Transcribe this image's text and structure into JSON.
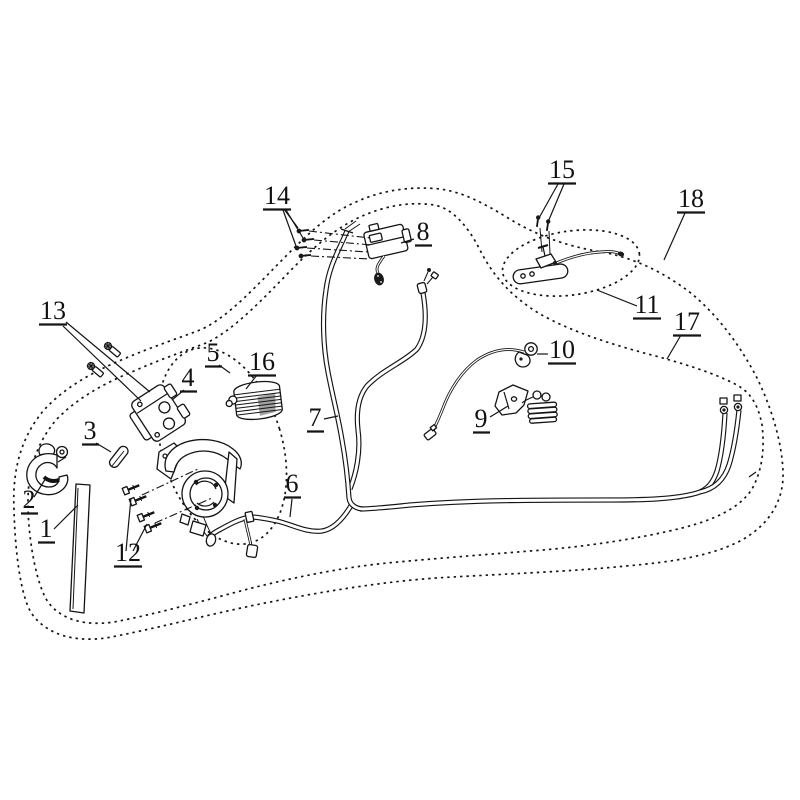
{
  "figure": {
    "kind": "exploded-parts-diagram",
    "colors": {
      "ink": "#141414",
      "paper": "#ffffff"
    },
    "callouts": [
      {
        "id": "1",
        "label": "1"
      },
      {
        "id": "2",
        "label": "2"
      },
      {
        "id": "3",
        "label": "3"
      },
      {
        "id": "4",
        "label": "4"
      },
      {
        "id": "5",
        "label": "5"
      },
      {
        "id": "6",
        "label": "6"
      },
      {
        "id": "7",
        "label": "7"
      },
      {
        "id": "8",
        "label": "8"
      },
      {
        "id": "9",
        "label": "9"
      },
      {
        "id": "10",
        "label": "10"
      },
      {
        "id": "11",
        "label": "11"
      },
      {
        "id": "12",
        "label": "12"
      },
      {
        "id": "13",
        "label": "13"
      },
      {
        "id": "14",
        "label": "14"
      },
      {
        "id": "15",
        "label": "15"
      },
      {
        "id": "16",
        "label": "16"
      },
      {
        "id": "17",
        "label": "17"
      },
      {
        "id": "18",
        "label": "18"
      }
    ]
  }
}
